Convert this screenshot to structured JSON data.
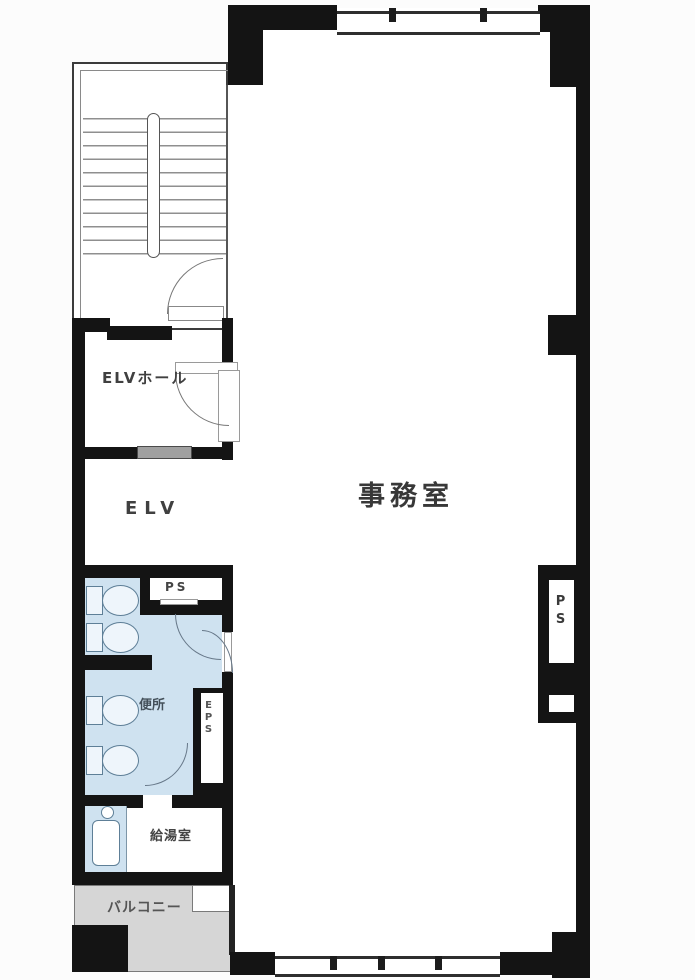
{
  "rooms": {
    "office": {
      "label": "事務室"
    },
    "elv_hall": {
      "label": "ELVホール"
    },
    "elv": {
      "label": "ELV"
    },
    "ps_upper": {
      "label": "PS"
    },
    "toilet": {
      "label": "便所"
    },
    "eps": {
      "label": "EPS"
    },
    "kitchenette": {
      "label": "給湯室"
    },
    "balcony": {
      "label": "バルコニー"
    },
    "ps_right": {
      "label": "PS"
    }
  },
  "colors": {
    "wall": "#141414",
    "toilet_fill": "#cfe2f0",
    "balcony_fill": "#d6d6d6",
    "elevator_door": "#a0a0a0",
    "line": "#777777",
    "text": "#3b3b3b"
  }
}
